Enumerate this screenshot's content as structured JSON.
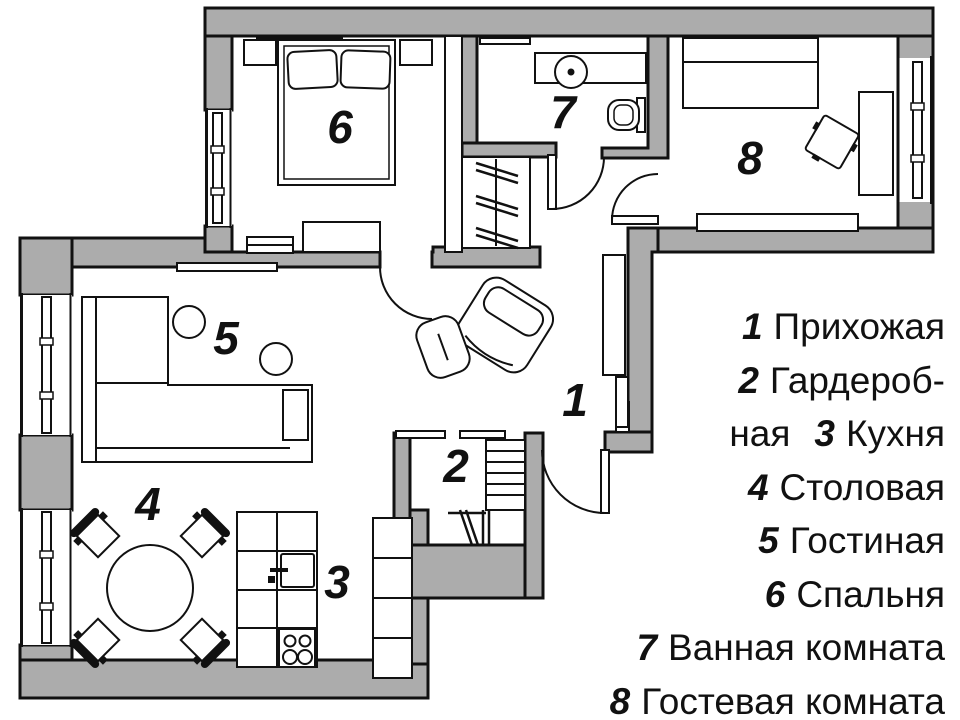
{
  "page": {
    "title": "План квартиры"
  },
  "colors": {
    "wall": "#ACACAC",
    "line": "#111111",
    "floor": "#FFFFFF",
    "text": "#111111"
  },
  "plan": {
    "room_numbers": [
      "1",
      "2",
      "3",
      "4",
      "5",
      "6",
      "7",
      "8"
    ]
  },
  "rooms": [
    {
      "number": "1",
      "name": "Прихожая"
    },
    {
      "number": "2",
      "name": "Гардеробная"
    },
    {
      "number": "3",
      "name": "Кухня"
    },
    {
      "number": "4",
      "name": "Столовая"
    },
    {
      "number": "5",
      "name": "Гостиная"
    },
    {
      "number": "6",
      "name": "Спальня"
    },
    {
      "number": "7",
      "name": "Ванная комната"
    },
    {
      "number": "8",
      "name": "Гостевая комната"
    }
  ],
  "legend": {
    "rows": [
      {
        "pre": "",
        "num": "1",
        "text": "Прихожая"
      },
      {
        "pre": "",
        "num": "2",
        "text": "Гардероб-"
      },
      {
        "pre": "ная",
        "num": "3",
        "text": "Кухня"
      },
      {
        "pre": "",
        "num": "4",
        "text": "Столовая"
      },
      {
        "pre": "",
        "num": "5",
        "text": "Гостиная"
      },
      {
        "pre": "",
        "num": "6",
        "text": "Спальня"
      },
      {
        "pre": "",
        "num": "7",
        "text": "Ванная комната"
      },
      {
        "pre": "",
        "num": "8",
        "text": "Гостевая комната"
      }
    ]
  }
}
